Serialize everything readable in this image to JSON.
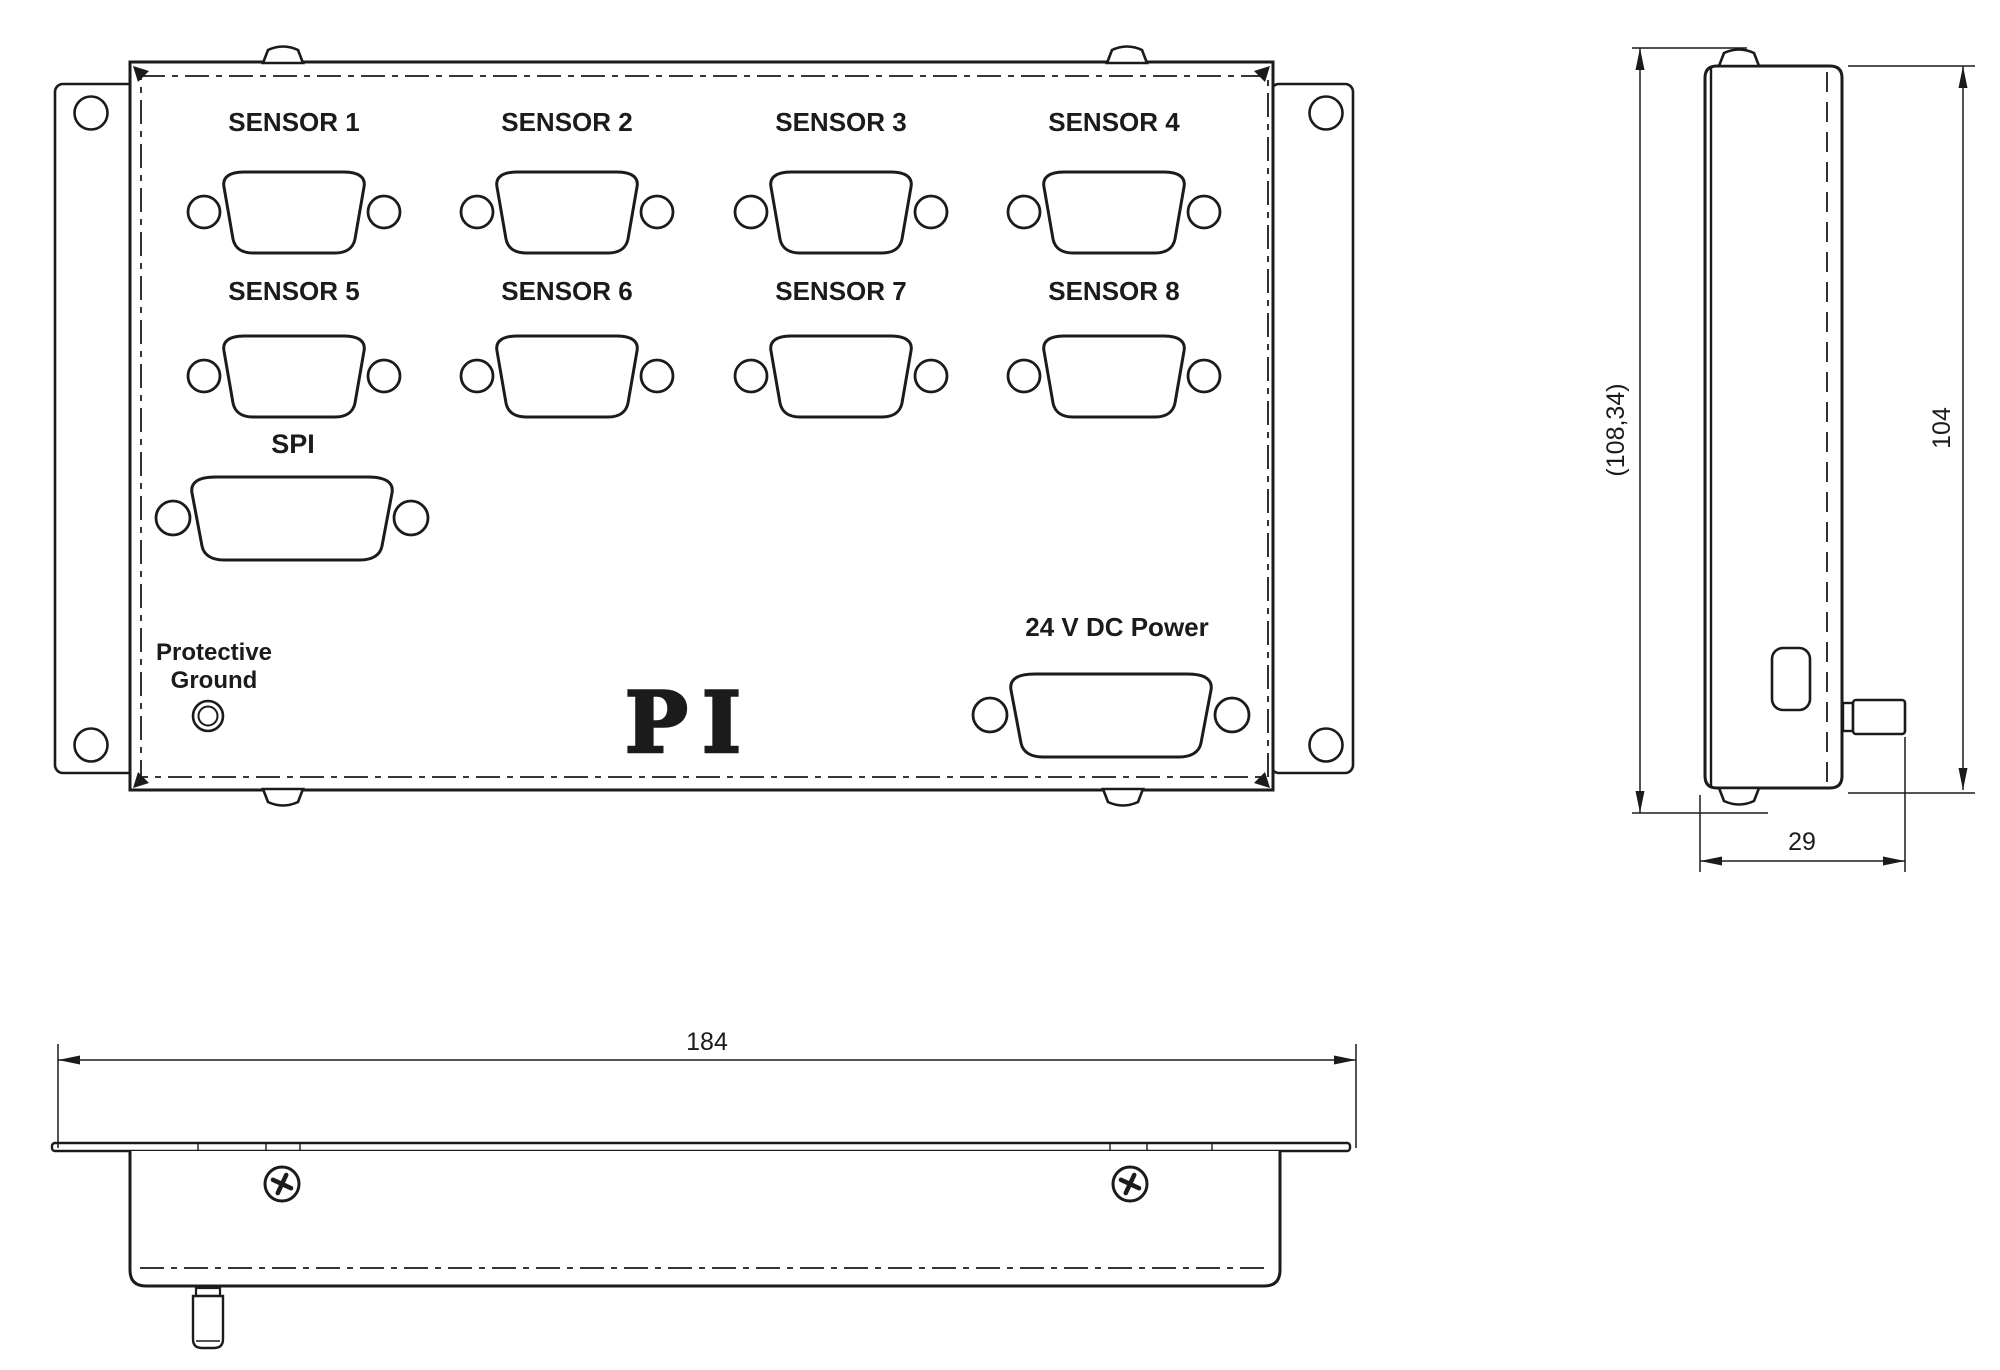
{
  "colors": {
    "line": "#1b1b1b",
    "background": "#ffffff"
  },
  "front_view": {
    "sensor_labels": [
      "SENSOR 1",
      "SENSOR 2",
      "SENSOR 3",
      "SENSOR 4",
      "SENSOR 5",
      "SENSOR 6",
      "SENSOR 7",
      "SENSOR 8"
    ],
    "spi_label": "SPI",
    "ground_label": {
      "line1": "Protective",
      "line2": "Ground"
    },
    "power_label": "24 V DC Power",
    "logo_text": "PI"
  },
  "dimensions": {
    "overall_width": "184",
    "panel_height": "104",
    "overall_height": "(108,34)",
    "depth": "29"
  },
  "icons": {
    "screw": "phillips-screw",
    "ground_terminal": "double-circle",
    "sensor_connector": "d-sub-9",
    "spi_connector": "d-sub-15",
    "power_connector": "d-sub-15"
  }
}
